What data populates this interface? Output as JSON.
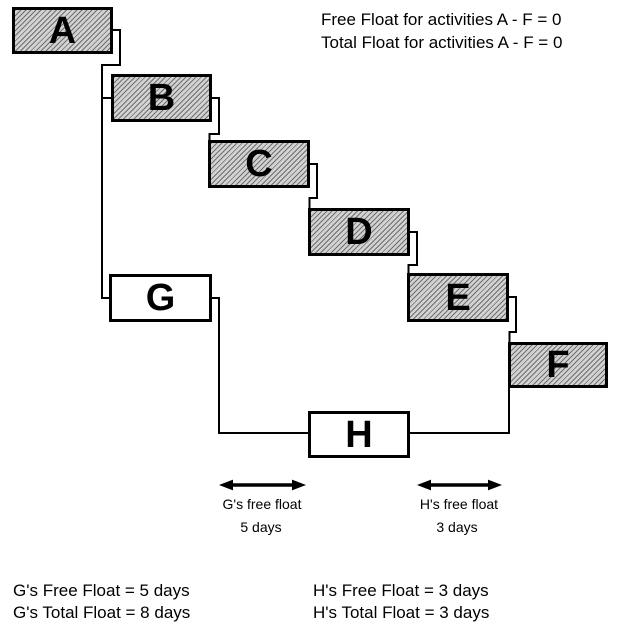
{
  "title_note": {
    "line1": "Free Float for activities A - F = 0",
    "line2": "Total Float for activities A - F = 0"
  },
  "activities": [
    {
      "label": "A",
      "fill": "hatched"
    },
    {
      "label": "B",
      "fill": "hatched"
    },
    {
      "label": "C",
      "fill": "hatched"
    },
    {
      "label": "D",
      "fill": "hatched"
    },
    {
      "label": "E",
      "fill": "hatched"
    },
    {
      "label": "F",
      "fill": "hatched"
    },
    {
      "label": "G",
      "fill": "plain"
    },
    {
      "label": "H",
      "fill": "plain"
    }
  ],
  "float_callouts": [
    {
      "label": "G's free float",
      "value": "5 days"
    },
    {
      "label": "H's free float",
      "value": "3 days"
    }
  ],
  "summary": {
    "left": [
      "G's Free Float = 5 days",
      "G's Total Float = 8 days"
    ],
    "right": [
      "H's Free Float = 3 days",
      "H's Total Float = 3 days"
    ]
  },
  "colors": {
    "background": "#ffffff",
    "box_border": "#000000",
    "hatch_dark": "#6e6e6e",
    "hatch_light": "#d2d2d2",
    "plain_fill": "#ffffff",
    "connector": "#000000",
    "text": "#000000"
  }
}
